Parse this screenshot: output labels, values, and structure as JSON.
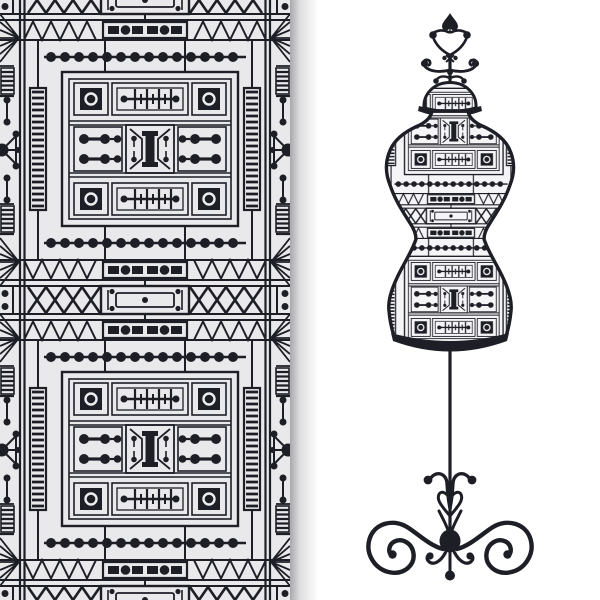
{
  "artwork": {
    "title": "Art Deco pattern with tailor's dress form",
    "alt": "Black and white vector illustration: left half is a seamless Art Deco ornamental pattern panel with a soft right drop shadow; right half shows a vintage tailor's dress form mannequin covered in the same geometric pattern, with a spade-shaped finial on top and an ornate wrought-iron scroll base on a thin pole.",
    "style": "monochrome line art"
  },
  "colors": {
    "ink": "#1e1e27",
    "panel_background": "#e9e9eb",
    "page_background": "#ffffff",
    "torso_background": "#f5f5f7",
    "ring": "#ededf0"
  },
  "pattern_motifs": [
    "central panel with corner squares and ringed eyelets",
    "barbed-wire tick bar",
    "bowtie trapezoids with serif I-beam",
    "dot dumbbell rows",
    "beaded dot line",
    "triangle zigzag band",
    "film-strip bar and dot box",
    "ladder columns",
    "edge sunburst fans",
    "X bowtie row",
    "framed bar box at tile seam"
  ],
  "mannequin_parts": [
    "spade finial",
    "scroll antlers",
    "patterned neck cap",
    "patterned torso",
    "black hem band",
    "stand pole",
    "scrolled iron base"
  ]
}
